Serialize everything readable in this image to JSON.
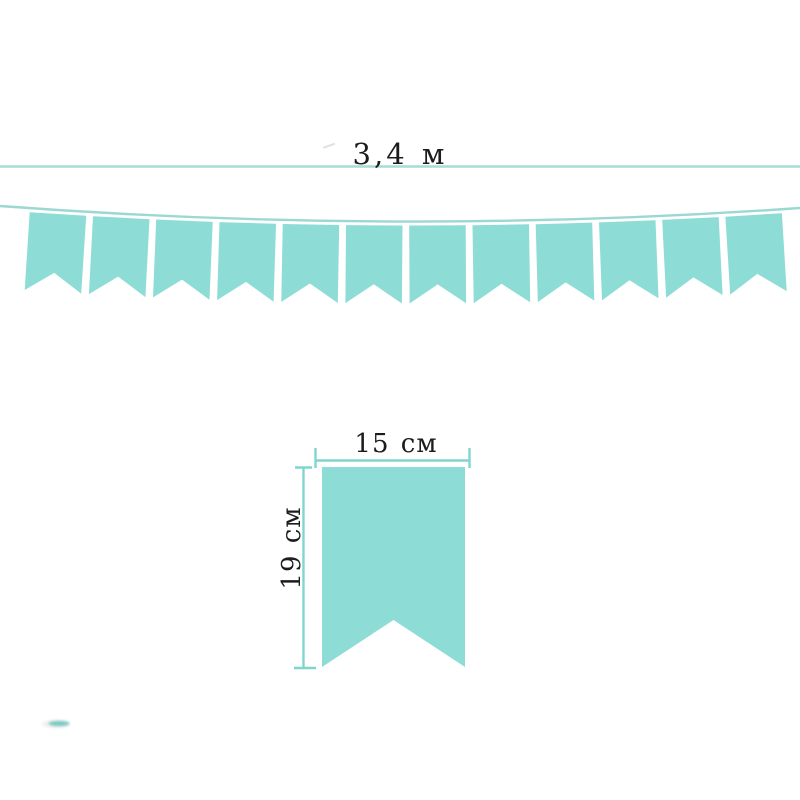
{
  "measurements": {
    "total_length": "3,4 м",
    "flag_width": "15 см",
    "flag_height": "19 см"
  },
  "garland": {
    "flag_count": 12
  },
  "colors": {
    "flag_fill": "#8edcd6",
    "string_line": "#9bd8d3",
    "top_measure_line": "#a9dcd8",
    "dimension_line": "#7fd6cf",
    "text": "#1c1c1c",
    "smudge_teal": "#58c2ba",
    "smudge_pink": "#f0dfe0",
    "faint_mark": "#c9c9c9",
    "background": "#ffffff"
  }
}
